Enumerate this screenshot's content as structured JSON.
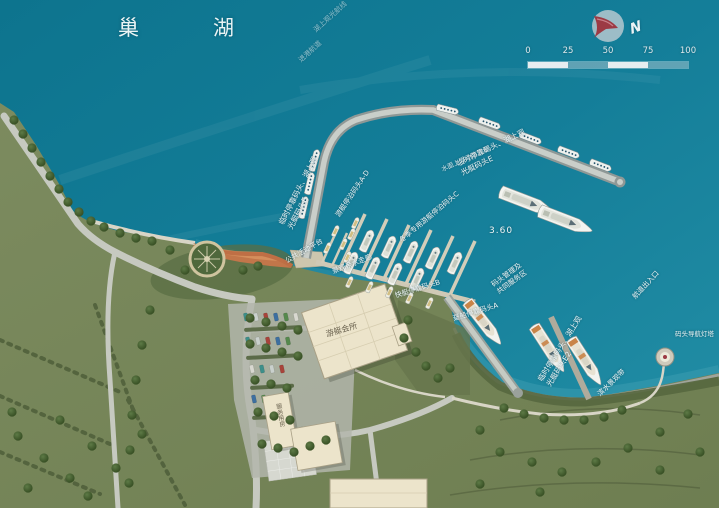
{
  "map": {
    "lake_name": "巢湖",
    "depth_marker": "3.60",
    "compass": {
      "north_label": "N"
    },
    "scale_bar": {
      "ticks": [
        "0",
        "25",
        "50",
        "75",
        "100"
      ]
    },
    "labels": {
      "route_upper": "湖上观光航线",
      "route_lower": "进港航道",
      "temp_dock_west": "临时停靠码头、湖上观\n光艇码头E",
      "temp_dock_ne": "临时停靠码头、湖上观\n光艇码头E",
      "floating_breakwater": "水面上浮动防波堤",
      "yacht_moorage_ad": "游艇停泊码头A-D",
      "winter_yacht_moorage": "冬季专用游艇停泊码头C",
      "dock_management": "码头管理及\n共同服务区",
      "public_platform": "公共活动平台",
      "waterfront_corridor": "景观亲水走廊",
      "speedboat_dock": "快艇停靠码头B",
      "pontoon_dock": "趸船停靠码头A",
      "temp_dock_se": "临时停靠码头、湖上观\n光艇码头E2",
      "channel_entrance": "航道出入口",
      "lighthouse": "码头导航灯塔",
      "waterfront_belt": "滨水景观带",
      "clubhouse": "游艇会所",
      "service_building": "服务用房"
    },
    "colors": {
      "water": "#137d98",
      "land": "#76855a",
      "beach": "#c2764a",
      "compass_arrow": "#9c3a44",
      "label_text": "#f0f6f7"
    }
  }
}
